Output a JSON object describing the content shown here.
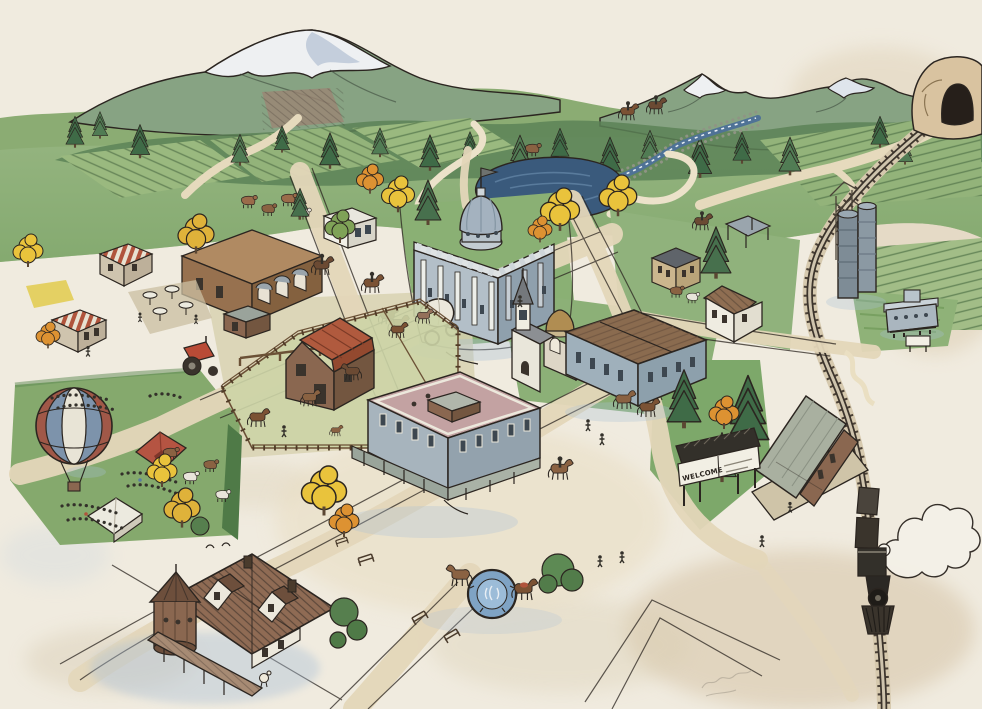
{
  "artwork": {
    "type": "watercolor-illustrated-town-map",
    "scene": "Bird's-eye pen-and-ink watercolor map of a small frontier town with mountains, pond, railroad, fairgrounds and steam train",
    "welcome_sign_text": "WELCOME"
  },
  "palette": {
    "paper": "#f0ebdf",
    "ink": "#2b2520",
    "grass_light": "#a9c18b",
    "grass_mid": "#85a96d",
    "grass_dark": "#5f8a54",
    "pine_green": "#47704d",
    "forest_green": "#5c8257",
    "mountain_green": "#87a383",
    "snow_shadow": "#b9c6d6",
    "pond_blue": "#3a5a7c",
    "creek_blue": "#4f7296",
    "road_tan": "#e4d7ba",
    "stain_tan": "#cdb795",
    "brick_brown": "#97714f",
    "barn_wall": "#8a6750",
    "barn_roof_red": "#b05a3e",
    "courthouse_grey": "#b3bfc8",
    "courthouse_shade": "#8fa0ad",
    "dome_grey": "#a4b2bf",
    "mercantile_grey": "#9fb0bb",
    "roof_mauve": "#c3a2a2",
    "roof_plank_brown": "#8a6b4f",
    "depot_roof": "#a9b0a0",
    "caboose_grey": "#aab6bf",
    "silo_steel": "#7e8c96",
    "balloon_blue": "#7d93ab",
    "balloon_red": "#a05848",
    "tent_red": "#b55442",
    "autumn_yellow": "#e9c33c",
    "autumn_orange": "#dd9232",
    "mansion_roof": "#8f6b54",
    "shadow_blue": "#aabfd6"
  },
  "landmarks": [
    {
      "id": "mountains-left",
      "label": "Snow-capped mountain (left)"
    },
    {
      "id": "mountains-right",
      "label": "Snow-capped range (right)"
    },
    {
      "id": "forest-ridge",
      "label": "Pine forest ridge"
    },
    {
      "id": "farm-fields",
      "label": "Plowed hillside fields"
    },
    {
      "id": "railroad-tunnel",
      "label": "Railroad tunnel portal"
    },
    {
      "id": "creek",
      "label": "Rocky creek"
    },
    {
      "id": "pond",
      "label": "Town pond"
    },
    {
      "id": "railroad-track",
      "label": "Railroad line"
    },
    {
      "id": "steam-train",
      "label": "Steam train with smoke"
    },
    {
      "id": "grain-elevator",
      "label": "Grain elevator and silos"
    },
    {
      "id": "train-depot",
      "label": "Train depot"
    },
    {
      "id": "caboose-display",
      "label": "Caboose on display"
    },
    {
      "id": "welcome-sign",
      "label": "Town welcome sign"
    },
    {
      "id": "courthouse",
      "label": "Domed courthouse with flag"
    },
    {
      "id": "church",
      "label": "Church with steeple"
    },
    {
      "id": "domed-chapel",
      "label": "Domed chapel"
    },
    {
      "id": "mercantile",
      "label": "Mercantile block"
    },
    {
      "id": "saloon-row",
      "label": "Brick saloon row with patio"
    },
    {
      "id": "bank-building",
      "label": "White bank building"
    },
    {
      "id": "awning-shops",
      "label": "Striped-awning shops"
    },
    {
      "id": "farmstead",
      "label": "Livery corral and barn"
    },
    {
      "id": "tractor",
      "label": "Red tractor"
    },
    {
      "id": "covered-wagon",
      "label": "Covered wagon"
    },
    {
      "id": "hotel",
      "label": "Grand hotel"
    },
    {
      "id": "fountain-plaza",
      "label": "Horse fountain plaza"
    },
    {
      "id": "victorian-mansion",
      "label": "Victorian mansion with turret"
    },
    {
      "id": "fairgrounds",
      "label": "Fairgrounds with crowd"
    },
    {
      "id": "hot-air-balloon",
      "label": "Hot-air balloon"
    },
    {
      "id": "festival-tents",
      "label": "Festival tents"
    },
    {
      "id": "livestock",
      "label": "Cattle and horses"
    },
    {
      "id": "horse-riders",
      "label": "Riders on horseback"
    },
    {
      "id": "autumn-trees",
      "label": "Golden autumn trees"
    },
    {
      "id": "artist-signature",
      "label": "Faint pencil signature"
    }
  ]
}
